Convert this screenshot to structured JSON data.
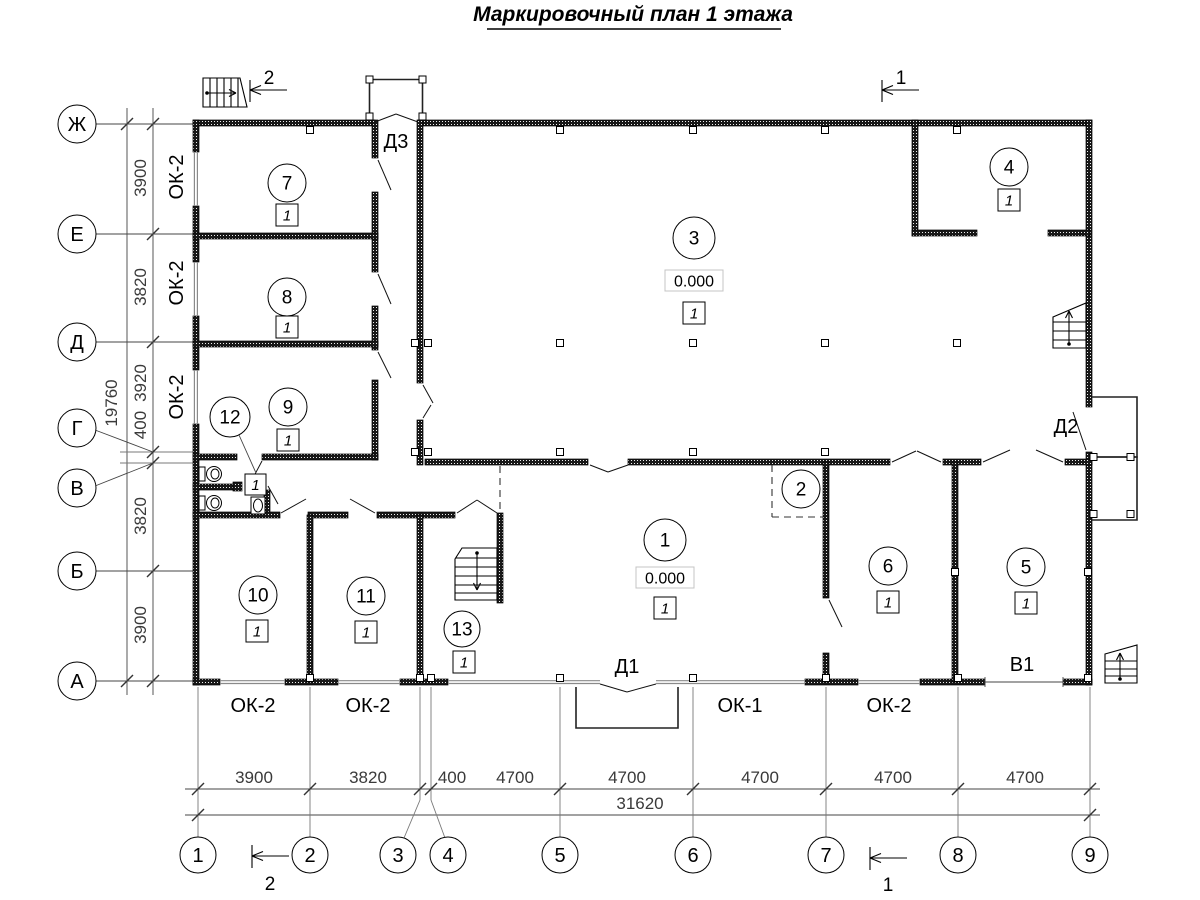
{
  "title": "Маркировочный план 1 этажа",
  "section_marks": {
    "top_left": "2",
    "top_right": "1",
    "bottom_left": "2",
    "bottom_right": "1"
  },
  "axes": {
    "rows": [
      {
        "label": "Ж"
      },
      {
        "label": "Е"
      },
      {
        "label": "Д"
      },
      {
        "label": "Г"
      },
      {
        "label": "В"
      },
      {
        "label": "Б"
      },
      {
        "label": "А"
      }
    ],
    "cols": [
      {
        "label": "1"
      },
      {
        "label": "2"
      },
      {
        "label": "3"
      },
      {
        "label": "4"
      },
      {
        "label": "5"
      },
      {
        "label": "6"
      },
      {
        "label": "7"
      },
      {
        "label": "8"
      },
      {
        "label": "9"
      }
    ]
  },
  "dimensions": {
    "left": {
      "segments": [
        "3900",
        "3820",
        "3920",
        "400",
        "3820",
        "3900"
      ],
      "overall": "19760"
    },
    "bottom": {
      "segments": [
        "3900",
        "3820",
        "400",
        "4700",
        "4700",
        "4700",
        "4700",
        "4700"
      ],
      "overall": "31620"
    }
  },
  "windows": {
    "left": [
      "ОК-2",
      "ОК-2",
      "ОК-2"
    ],
    "bottom": [
      "ОК-2",
      "ОК-2",
      "ОК-1",
      "ОК-2"
    ]
  },
  "doors": {
    "d1": "Д1",
    "d2": "Д2",
    "d3": "Д3",
    "gate": "В1"
  },
  "rooms": {
    "r1": {
      "number": "1",
      "elevation": "0.000",
      "tag": "1"
    },
    "r2": {
      "number": "2"
    },
    "r3": {
      "number": "3",
      "elevation": "0.000",
      "tag": "1"
    },
    "r4": {
      "number": "4",
      "tag": "1"
    },
    "r5": {
      "number": "5",
      "tag": "1"
    },
    "r6": {
      "number": "6",
      "tag": "1"
    },
    "r7": {
      "number": "7",
      "tag": "1"
    },
    "r8": {
      "number": "8",
      "tag": "1"
    },
    "r9": {
      "number": "9",
      "tag": "1"
    },
    "r10": {
      "number": "10",
      "tag": "1"
    },
    "r11": {
      "number": "11",
      "tag": "1"
    },
    "r12": {
      "number": "12",
      "tag": "1"
    },
    "r13": {
      "number": "13",
      "tag": "1"
    }
  }
}
